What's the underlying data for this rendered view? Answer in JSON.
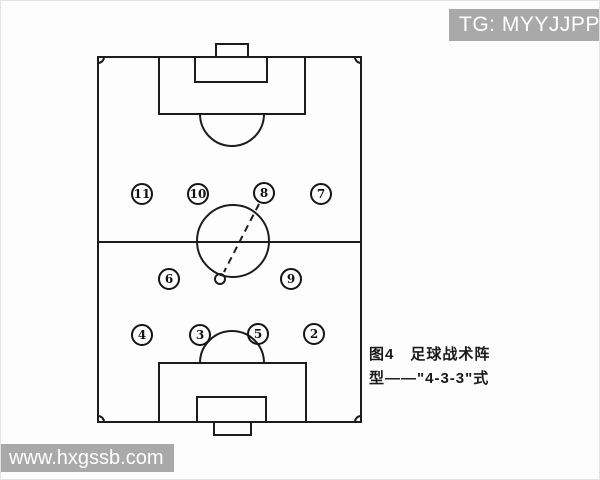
{
  "watermarks": {
    "telegram": "TG: MYYJJPP",
    "website": "www.hxgssb.com"
  },
  "caption": {
    "line1": "图4　足球战术阵",
    "line2": "型——\"4-3-3\"式",
    "full_text": "图4 足球战术阵型——\"4-3-3\"式"
  },
  "diagram": {
    "type": "football-formation",
    "formation": "4-3-3",
    "players": [
      {
        "number": "11",
        "x": 141,
        "y": 193,
        "row": "front"
      },
      {
        "number": "10",
        "x": 197,
        "y": 193,
        "row": "front"
      },
      {
        "number": "8",
        "x": 263,
        "y": 192,
        "row": "front"
      },
      {
        "number": "7",
        "x": 320,
        "y": 193,
        "row": "front"
      },
      {
        "number": "6",
        "x": 168,
        "y": 278,
        "row": "middle"
      },
      {
        "number": "9",
        "x": 290,
        "y": 278,
        "row": "middle"
      },
      {
        "number": "4",
        "x": 141,
        "y": 334,
        "row": "back"
      },
      {
        "number": "3",
        "x": 199,
        "y": 334,
        "row": "back"
      },
      {
        "number": "5",
        "x": 257,
        "y": 333,
        "row": "back"
      },
      {
        "number": "2",
        "x": 313,
        "y": 333,
        "row": "back"
      }
    ],
    "ball": {
      "x": 219,
      "y": 278,
      "r": 5
    },
    "pass_line": {
      "from_player": "8",
      "x1": 258,
      "y1": 203,
      "x2": 223,
      "y2": 271
    }
  },
  "colors": {
    "watermark_bg": "#a9a9a9",
    "watermark_text": "#ffffff",
    "line_color": "#1c1c1c",
    "background": "#fdfdfd"
  }
}
